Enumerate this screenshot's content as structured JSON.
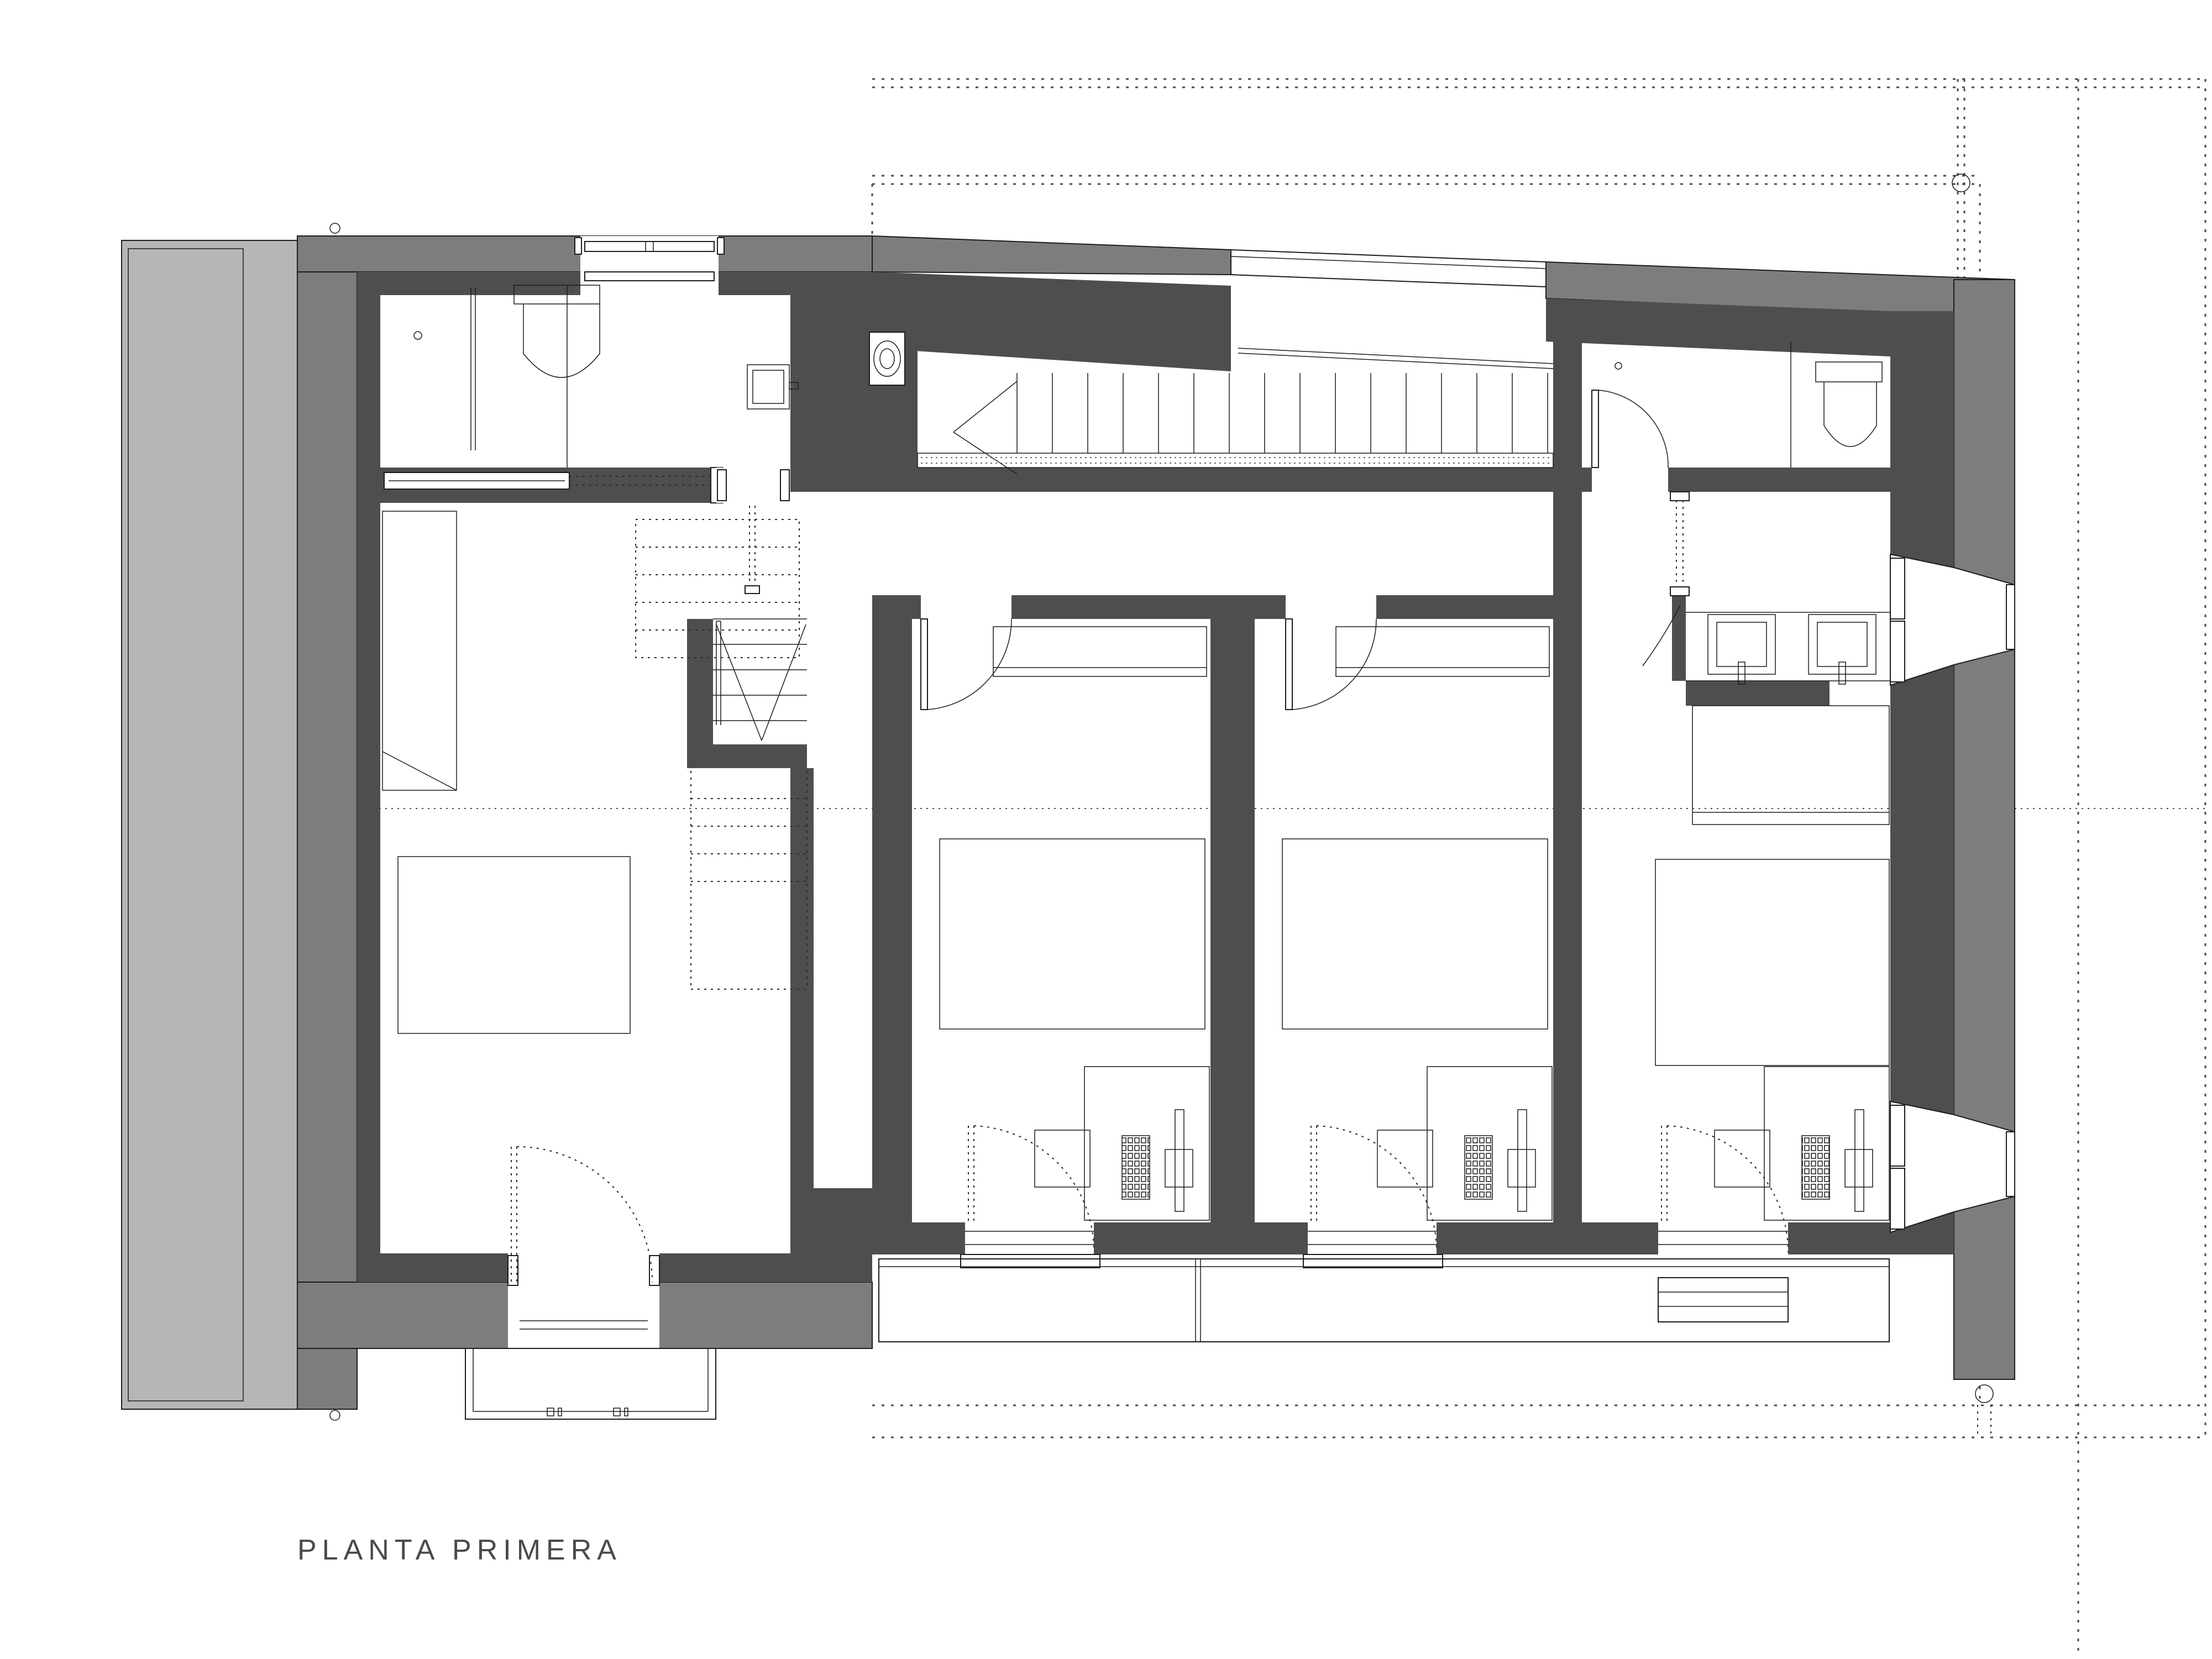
{
  "drawing": {
    "title": "PLANTA PRIMERA",
    "type": "architectural-floor-plan"
  },
  "palette": {
    "background": "#ffffff",
    "terrace_fill": "#b6b6b6",
    "outer_wall_fill": "#7d7d7d",
    "inner_wall_fill": "#4e4e4e",
    "line_color": "#1c1c1c",
    "reference_dotted_color": "#4a4a4a"
  },
  "inventory": {
    "bedrooms": 3,
    "bathrooms": 2,
    "staircases": 2,
    "balconies": 2,
    "terraces": 1,
    "beds": 4,
    "desks_with_computers": 3,
    "wash_basins": 3,
    "toilets": 2,
    "showers": 1,
    "wardrobes": 4,
    "column_markers": 4
  }
}
